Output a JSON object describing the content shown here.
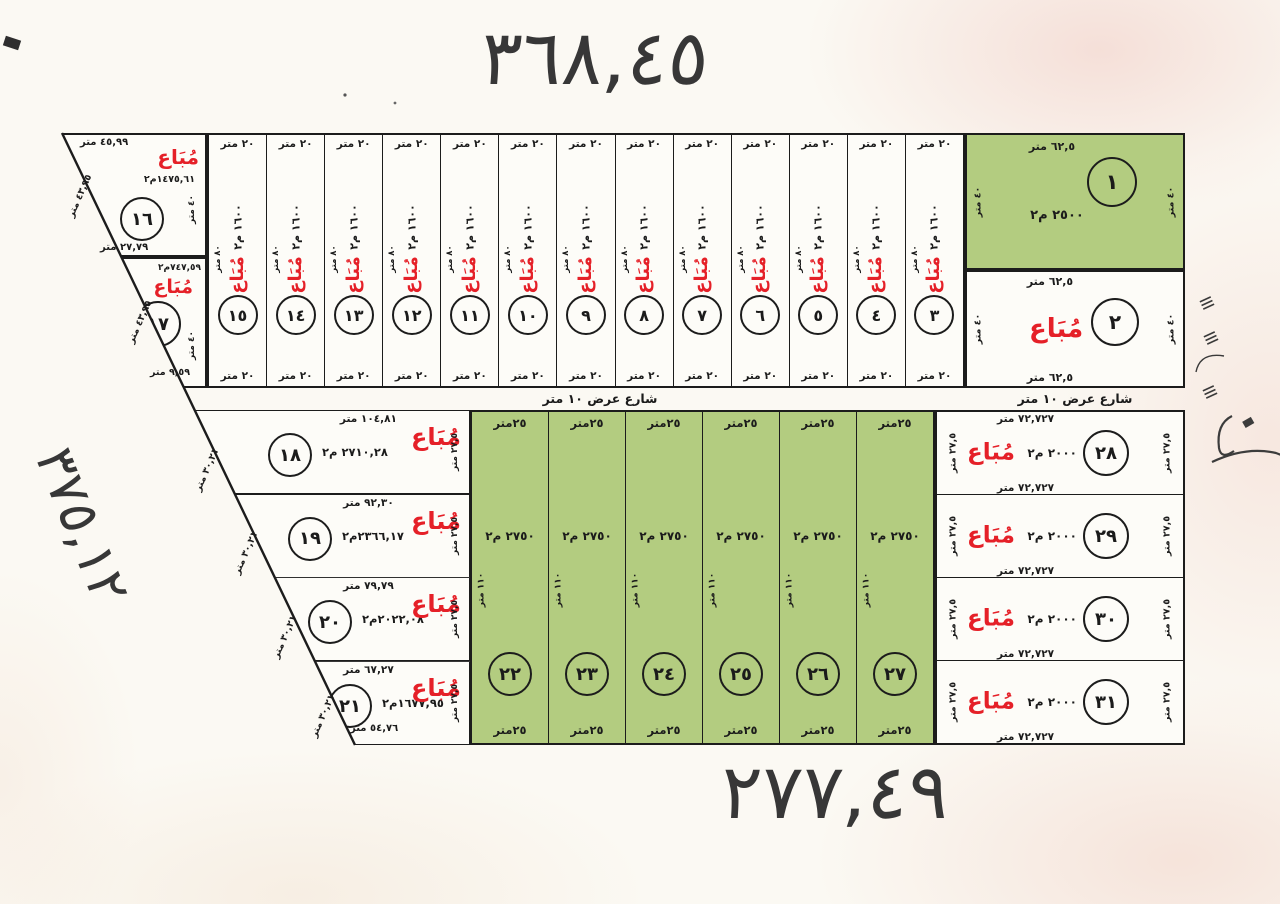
{
  "titles": {
    "top": "٣٦٨,٤٥",
    "bottom": "٢٧٧,٤٩",
    "left": "٣٧٥,١٢"
  },
  "street": {
    "label": "شارع عرض ١٠ متر"
  },
  "stamp": {
    "sold": "مُبَاع"
  },
  "colors": {
    "parcel_green": "#b3cc80",
    "stamp_red": "#e52028",
    "ink": "#1c1c1c",
    "paper": "#fbf9f3"
  },
  "plot1": {
    "number": "١",
    "top_len": "٦٢,٥ متر",
    "area": "٢٥٠٠ م٢",
    "side_len": "٤٠ متر"
  },
  "plot2": {
    "number": "٢",
    "top_len": "٦٢,٥ متر",
    "bottom_len": "٦٢,٥ متر",
    "side_len": "٤٠ متر"
  },
  "plot16": {
    "number": "١٦",
    "top_len": "٤٥,٩٩ متر",
    "bottom_len": "٢٧,٧٩ متر",
    "side_len": "٤٠ متر",
    "slant_len": "٤٣,٩٥ متر",
    "area": "١٤٧٥,٦١م٢"
  },
  "plot17": {
    "number": "١٧",
    "area": "٧٤٧,٥٩م٢",
    "bottom_len": "٩,٥٩ متر",
    "side_len": "٤٠ متر",
    "slant_len": "٤٣,٩٥ متر"
  },
  "top_strips": [
    {
      "number": "١٥",
      "top_len": "٢٠ متر",
      "bottom_len": "٢٠ متر",
      "depth": "٨٠ متر",
      "area": "١٦٠٠ م٢"
    },
    {
      "number": "١٤",
      "top_len": "٢٠ متر",
      "bottom_len": "٢٠ متر",
      "depth": "٨٠ متر",
      "area": "١٦٠٠ م٢"
    },
    {
      "number": "١٣",
      "top_len": "٢٠ متر",
      "bottom_len": "٢٠ متر",
      "depth": "٨٠ متر",
      "area": "١٦٠٠ م٢"
    },
    {
      "number": "١٢",
      "top_len": "٢٠ متر",
      "bottom_len": "٢٠ متر",
      "depth": "٨٠ متر",
      "area": "١٦٠٠ م٢"
    },
    {
      "number": "١١",
      "top_len": "٢٠ متر",
      "bottom_len": "٢٠ متر",
      "depth": "٨٠ متر",
      "area": "١٦٠٠ م٢"
    },
    {
      "number": "١٠",
      "top_len": "٢٠ متر",
      "bottom_len": "٢٠ متر",
      "depth": "٨٠ متر",
      "area": "١٦٠٠ م٢"
    },
    {
      "number": "٩",
      "top_len": "٢٠ متر",
      "bottom_len": "٢٠ متر",
      "depth": "٨٠ متر",
      "area": "١٦٠٠ م٢"
    },
    {
      "number": "٨",
      "top_len": "٢٠ متر",
      "bottom_len": "٢٠ متر",
      "depth": "٨٠ متر",
      "area": "١٦٠٠ م٢"
    },
    {
      "number": "٧",
      "top_len": "٢٠ متر",
      "bottom_len": "٢٠ متر",
      "depth": "٨٠ متر",
      "area": "١٦٠٠ م٢"
    },
    {
      "number": "٦",
      "top_len": "٢٠ متر",
      "bottom_len": "٢٠ متر",
      "depth": "٨٠ متر",
      "area": "١٦٠٠ م٢"
    },
    {
      "number": "٥",
      "top_len": "٢٠ متر",
      "bottom_len": "٢٠ متر",
      "depth": "٨٠ متر",
      "area": "١٦٠٠ م٢"
    },
    {
      "number": "٤",
      "top_len": "٢٠ متر",
      "bottom_len": "٢٠ متر",
      "depth": "٨٠ متر",
      "area": "١٦٠٠ م٢"
    },
    {
      "number": "٣",
      "top_len": "٢٠ متر",
      "bottom_len": "٢٠ متر",
      "depth": "٨٠ متر",
      "area": "١٦٠٠ م٢"
    }
  ],
  "bottom_left": [
    {
      "number": "١٨",
      "top_len": "١٠٤,٨١ متر",
      "area": "٢٧١٠,٢٨ م٢",
      "side_len": "٢٧,٥ متر",
      "slant_len": "٣٠,٢١ متر"
    },
    {
      "number": "١٩",
      "top_len": "٩٢,٣٠ متر",
      "area": "٢٣٦٦,١٧م٢",
      "side_len": "٢٧,٥ متر",
      "slant_len": "٣٠,٢١ متر"
    },
    {
      "number": "٢٠",
      "top_len": "٧٩,٧٩ متر",
      "area": "٢٠٢٢,٠٨م٢",
      "side_len": "٢٧,٥ متر",
      "slant_len": "٣٠,٢١ متر"
    },
    {
      "number": "٢١",
      "top_len": "٦٧,٢٧ متر",
      "area": "١٦٧٧,٩٥م٢",
      "side_len": "٢٧,٥ متر",
      "slant_len": "٣٠,٢١ متر",
      "bottom_len": "٥٤,٧٦ متر"
    }
  ],
  "bottom_green": [
    {
      "number": "٢٢",
      "top_len": "٢٥متر",
      "bottom_len": "٢٥متر",
      "depth": "١١٠ متر",
      "area": "٢٧٥٠ م٢"
    },
    {
      "number": "٢٣",
      "top_len": "٢٥متر",
      "bottom_len": "٢٥متر",
      "depth": "١١٠ متر",
      "area": "٢٧٥٠ م٢"
    },
    {
      "number": "٢٤",
      "top_len": "٢٥متر",
      "bottom_len": "٢٥متر",
      "depth": "١١٠ متر",
      "area": "٢٧٥٠ م٢"
    },
    {
      "number": "٢٥",
      "top_len": "٢٥متر",
      "bottom_len": "٢٥متر",
      "depth": "١١٠ متر",
      "area": "٢٧٥٠ م٢"
    },
    {
      "number": "٢٦",
      "top_len": "٢٥متر",
      "bottom_len": "٢٥متر",
      "depth": "١١٠ متر",
      "area": "٢٧٥٠ م٢"
    },
    {
      "number": "٢٧",
      "top_len": "٢٥متر",
      "bottom_len": "٢٥متر",
      "depth": "١١٠ متر",
      "area": "٢٧٥٠ م٢"
    }
  ],
  "bottom_right": [
    {
      "number": "٢٨",
      "top_len": "٧٢,٧٢٧ متر",
      "bottom_len": "٧٢,٧٢٧ متر",
      "area": "٢٠٠٠ م٢",
      "side_len": "٢٧,٥ متر"
    },
    {
      "number": "٢٩",
      "bottom_len": "٧٢,٧٢٧ متر",
      "area": "٢٠٠٠ م٢",
      "side_len": "٢٧,٥ متر"
    },
    {
      "number": "٣٠",
      "bottom_len": "٧٢,٧٢٧ متر",
      "area": "٢٠٠٠ م٢",
      "side_len": "٢٧,٥ متر"
    },
    {
      "number": "٣١",
      "bottom_len": "٧٢,٧٢٧ متر",
      "area": "٢٠٠٠ م٢",
      "side_len": "٢٧,٥ متر"
    }
  ]
}
